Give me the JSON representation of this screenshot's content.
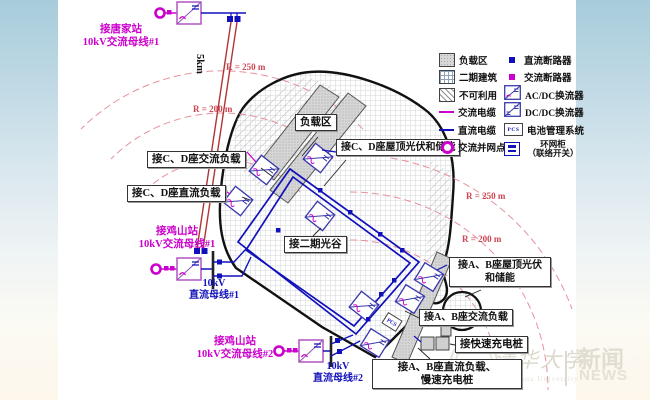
{
  "stations": {
    "tangjia": {
      "l1": "接唐家站",
      "l2": "10kV交流母线#1"
    },
    "jishan1": {
      "l1": "接鸡山站",
      "l2": "10kV交流母线#1"
    },
    "jishan2": {
      "l1": "接鸡山站",
      "l2": "10kV交流母线#2"
    }
  },
  "buses": {
    "dc1": {
      "l1": "10kV",
      "l2": "直流母线#1"
    },
    "dc2": {
      "l1": "10kV",
      "l2": "直流母线#2"
    }
  },
  "distance": "5km",
  "radius": {
    "tl_outer": "R = 250 m",
    "tl_inner": "R = 200 m",
    "r_outer": "R = 250 m",
    "r_inner": "R = 200 m"
  },
  "areas": {
    "load": "负载区",
    "cd_pv": "接C、D座屋顶光伏和储能",
    "cd_ac": "接C、D座交流负载",
    "cd_dc": "接C、D座直流负载",
    "phase2": "接二期光谷",
    "ab_pv1": "接A、B座屋顶光伏",
    "ab_pv2": "和储能",
    "ab_ac": "接A、B座交流负载",
    "fast": "接快速充电桩",
    "ab_dc1": "接A、B座直流负载、",
    "ab_dc2": "慢速充电桩"
  },
  "legend_left": [
    "负载区",
    "二期建筑",
    "不可利用",
    "交流电缆",
    "直流电缆",
    "交流并网点"
  ],
  "legend_right": [
    "直流断路器",
    "交流断路器",
    "AC/DC换流器",
    "DC/DC换流器",
    "电池管理系统",
    "环网柜",
    "（联络开关）"
  ],
  "pcs": "PCS",
  "watermark": {
    "uni_cn": "清华大学",
    "uni_en": "Tsinghua University",
    "news_cn": "新闻",
    "news_en": "NEWS"
  },
  "colors": {
    "ac": "#cc00cc",
    "dc": "#1111bb",
    "feeder": "#b03535",
    "radius_label": "#cc4450",
    "boundary": "#111111"
  }
}
